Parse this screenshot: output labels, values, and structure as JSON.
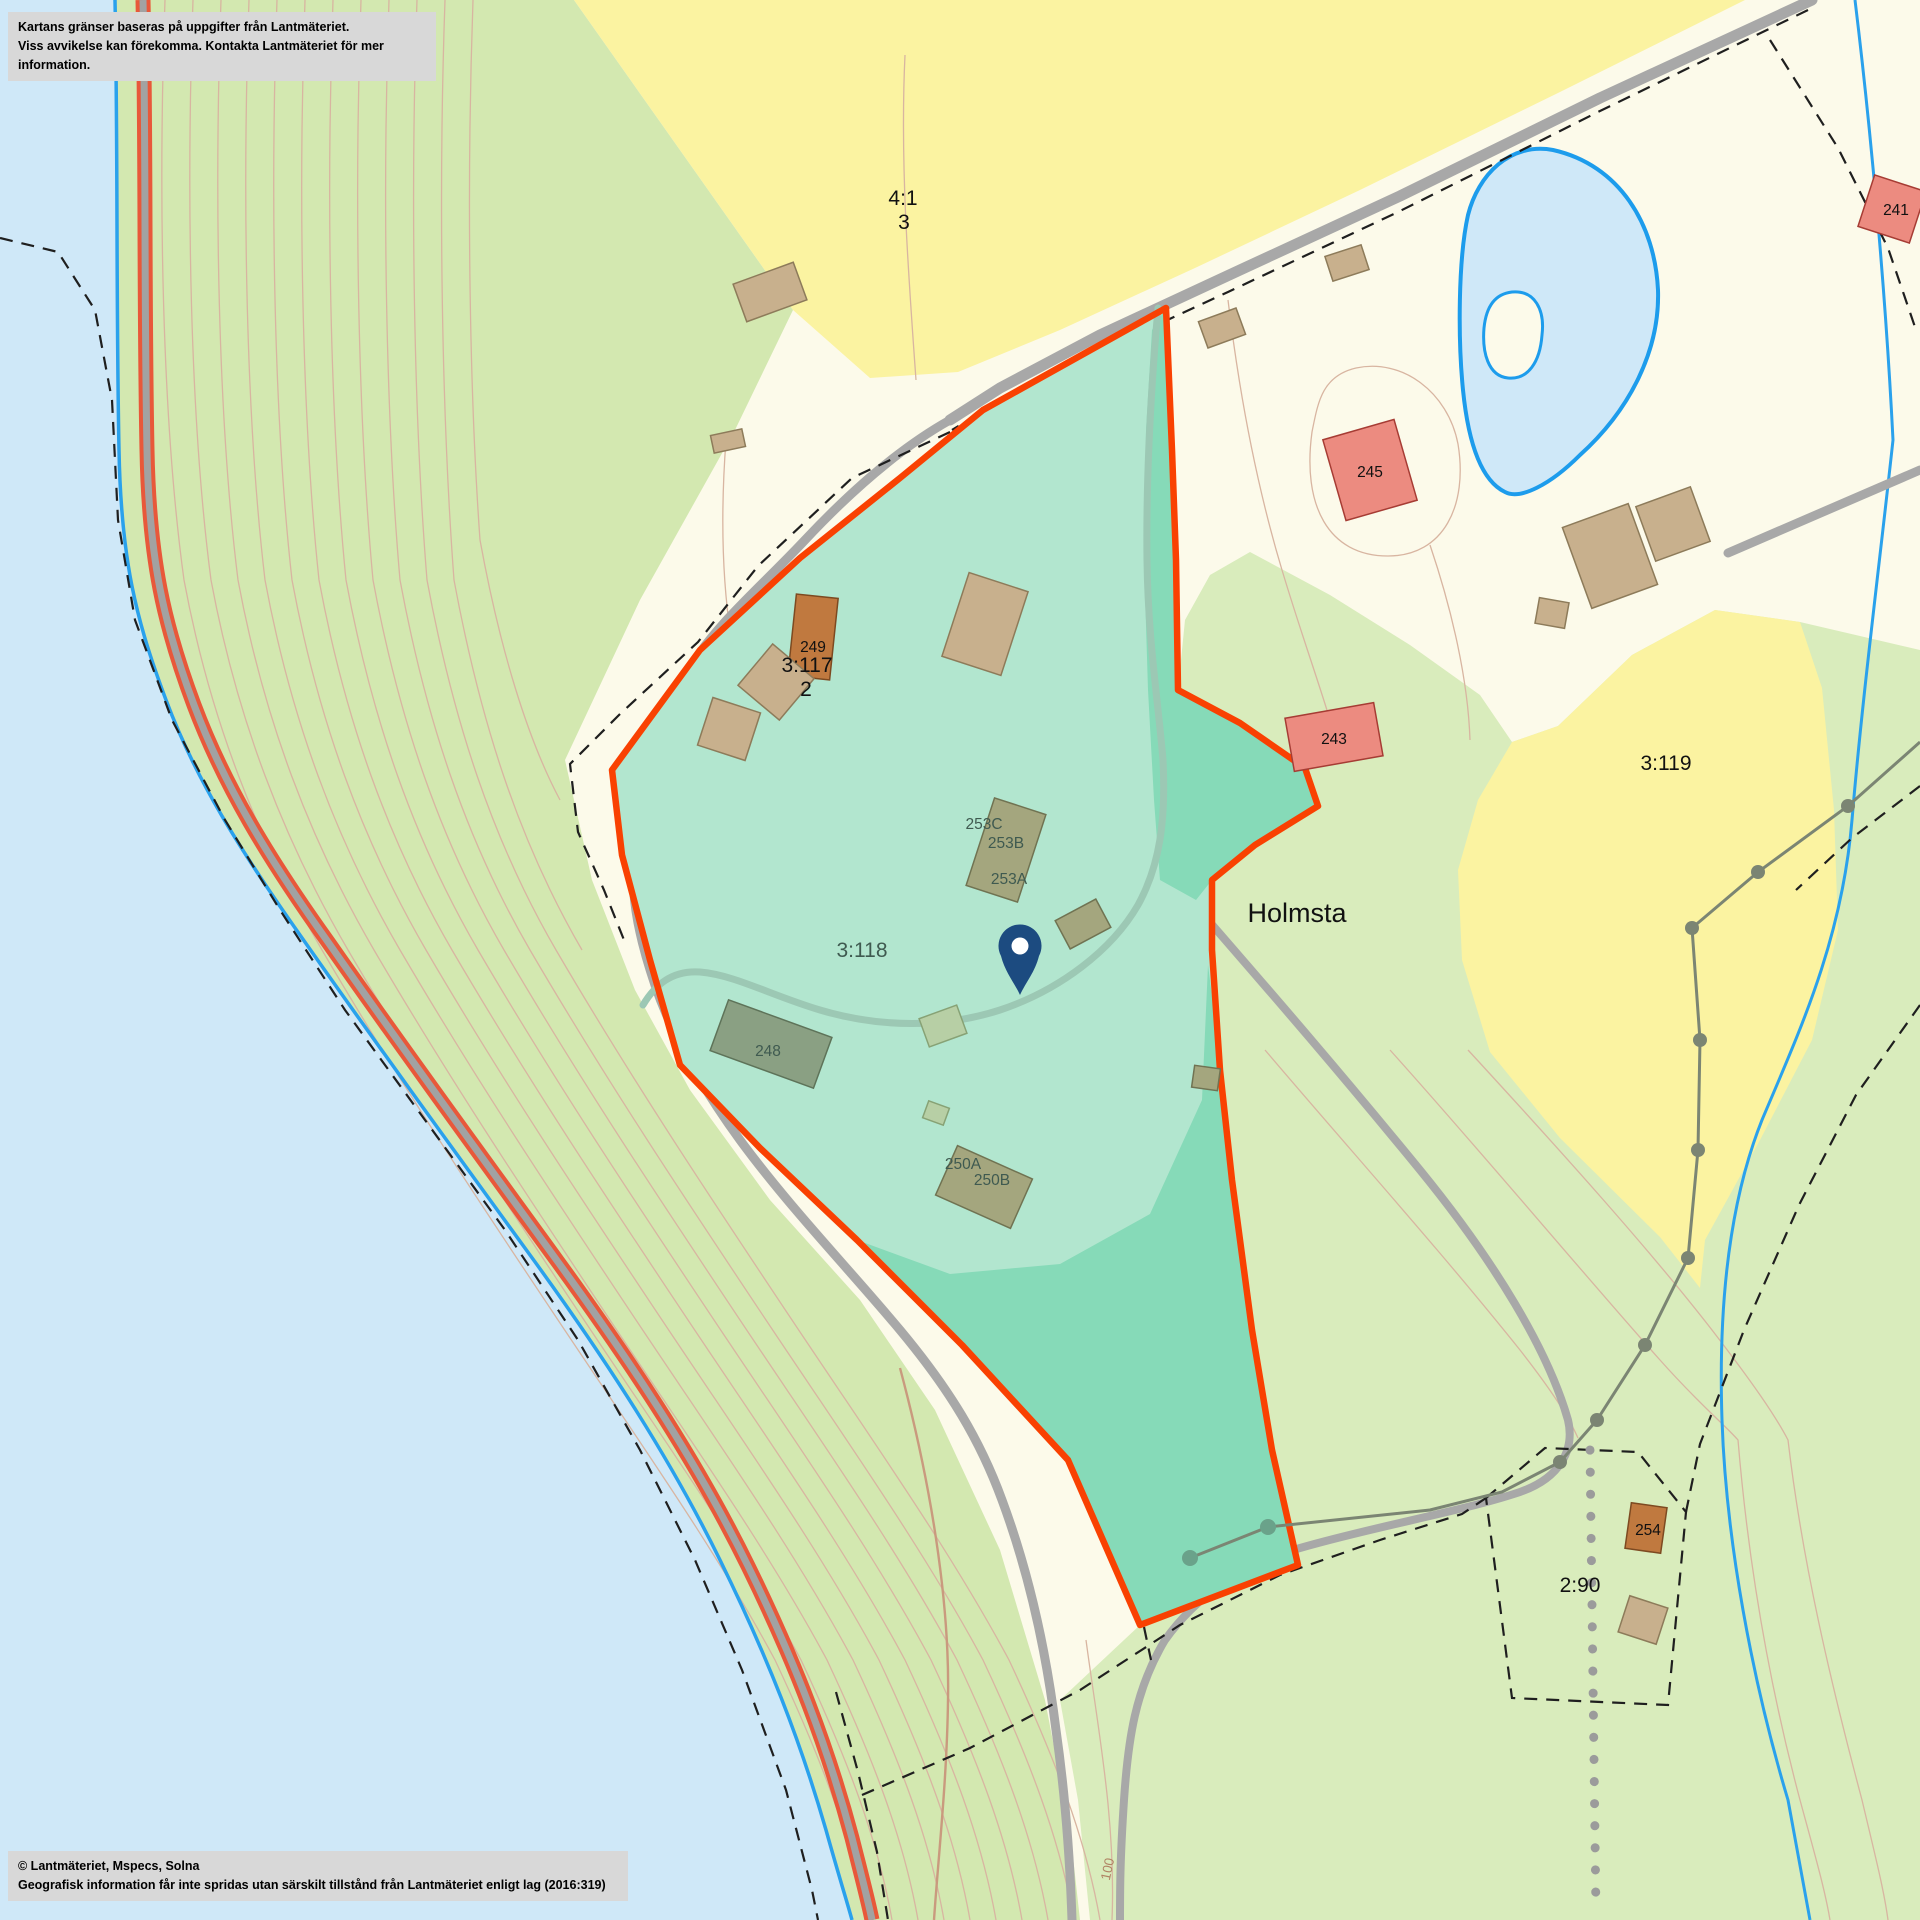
{
  "map": {
    "notice_top": {
      "line1": "Kartans gränser baseras på uppgifter från Lantmäteriet.",
      "line2": "Viss avvikelse kan förekomma. Kontakta Lantmäteriet för mer information."
    },
    "notice_bottom": {
      "line1": "© Lantmäteriet, Mspecs, Solna",
      "line2": "Geografisk information får inte spridas utan särskilt tillstånd från Lantmäteriet enligt lag (2016:319)"
    },
    "labels": {
      "parcel_4_1": "4:1",
      "parcel_4_1_sub": "3",
      "parcel_3_117": "3:117",
      "parcel_3_117_sub": "2",
      "parcel_3_118": "3:118",
      "parcel_3_119": "3:119",
      "parcel_2_90": "2:90",
      "place_holmsta": "Holmsta",
      "bldg_241": "241",
      "bldg_243": "243",
      "bldg_245": "245",
      "bldg_248": "248",
      "bldg_249": "249",
      "bldg_250a": "250A",
      "bldg_250b": "250B",
      "bldg_253a": "253A",
      "bldg_253b": "253B",
      "bldg_253c": "253C",
      "bldg_254": "254",
      "contour_100": "100"
    },
    "marker": {
      "type": "location-pin"
    },
    "colors": {
      "base_land": "#fcfaea",
      "water": "#cfe8f8",
      "shoreline": "#2aa1ec",
      "forest_west": "#d3e8b0",
      "forest_east": "#d9ecbc",
      "field_yellow": "#fbf3a1",
      "pond_outline": "#1d9cec",
      "road_gray": "#a8a8a8",
      "road_red_edge": "#e8583a",
      "parcel_fill": "#b2e6cf",
      "parcel_fill_shaded": "#86dab8",
      "parcel_stroke": "#f94102",
      "building_tan": "#c8b08d",
      "building_red": "#ec8b80",
      "building_brown": "#c0793f",
      "building_olive": "#a4a67e",
      "pin": "#1c4b80",
      "contour": "#d8b5a1",
      "label_dark": "#3f5a50",
      "notice_bg": "#d8d8d8"
    }
  }
}
